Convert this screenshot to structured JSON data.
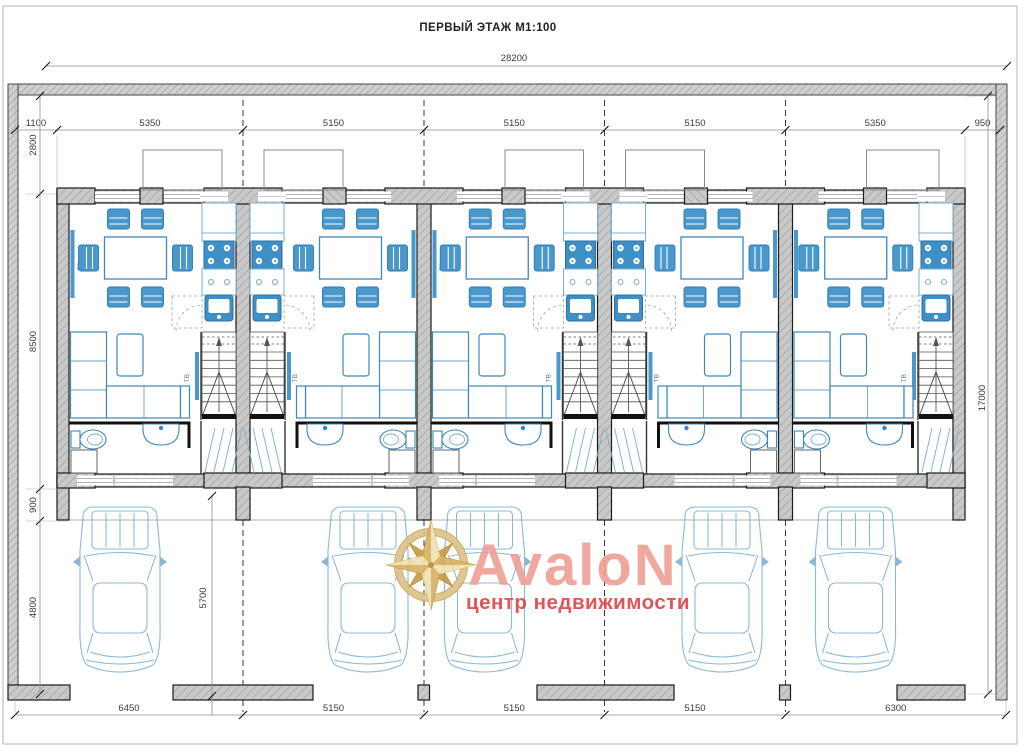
{
  "title": "ПЕРВЫЙ ЭТАЖ М1:100",
  "logo": {
    "name": "AvaloN",
    "subtitle": "центр недвижимости"
  },
  "labels": {
    "hall": "ХОЛ",
    "tv": "ТВ",
    "washer": "СМ"
  },
  "colors": {
    "furniture_stroke": "#3c87bd",
    "furniture_fill": "#4a97cc",
    "furniture_light": "#78aed4",
    "appliance_blue": "#3e8fc7",
    "car_stroke": "#8ab9d8",
    "wall_fill": "#c9c9c9",
    "wall_stroke": "#1a1a1a",
    "dim_text": "#3a3a3a",
    "dim_line": "#8f8f8f",
    "logo_gold": "#c9a54e",
    "logo_gold_light": "#dcc18a",
    "logo_name_color": "#ee9e94",
    "logo_subtitle_color": "#dd4343"
  },
  "dimensions": {
    "overall_width": "28200",
    "top_segments": [
      "1100",
      "5350",
      "5150",
      "5150",
      "5150",
      "5350",
      "950"
    ],
    "left_segments": [
      "2800",
      "8500",
      "900",
      "4800"
    ],
    "overall_height": "17000",
    "bottom_segments": [
      "6450",
      "5150",
      "5150",
      "5150",
      "6300"
    ],
    "driveway_depth": "5700"
  },
  "units": [
    {
      "id": "unit-1"
    },
    {
      "id": "unit-2"
    },
    {
      "id": "unit-3"
    },
    {
      "id": "unit-4"
    },
    {
      "id": "unit-5"
    }
  ]
}
